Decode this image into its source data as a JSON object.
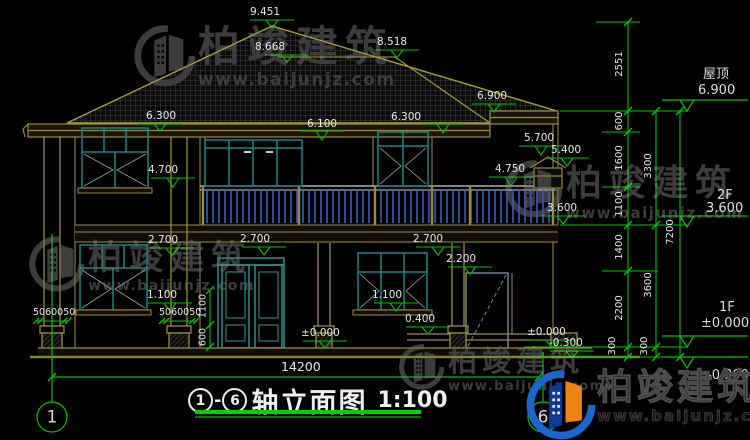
{
  "brand": {
    "name": "柏竣建筑",
    "site": "www.baijunjz.com"
  },
  "title": {
    "axis_from": "1",
    "dash": "-",
    "axis_to": "6",
    "text": "轴立面图",
    "scale": "1:100"
  },
  "axes": {
    "left_bubble": "1",
    "right_bubble": "6"
  },
  "total_width_dim": "14200",
  "right_levels": {
    "roof_label": "屋顶",
    "roof_value": "6.900",
    "f2_label": "2F",
    "f2_value": "3.600",
    "f1_label": "1F",
    "f1_value": "±0.000",
    "ground_value": "-0.300"
  },
  "chains": {
    "a": [
      "2551",
      "600",
      "1600",
      "1100",
      "1400",
      "2200",
      "300"
    ],
    "b": [
      "3300",
      "3600",
      "300"
    ],
    "c": [
      "7200"
    ]
  },
  "marks": {
    "ridge_main": "9.451",
    "ridge_side": "8.518",
    "ridge_rear": "8.668",
    "eave_left": "6.300",
    "win2f_head": "6.100",
    "eave_center": "6.300",
    "eave_right": "6.900",
    "turret_top": "5.700",
    "turret_eave": "5.400",
    "rail_top": "4.750",
    "sill_2f": "4.700",
    "slab_2f": "3.600",
    "head_1f_left": "2.700",
    "head_1f_center": "2.700",
    "head_1f_right": "2.700",
    "door_right_head": "2.200",
    "sill_1f_left": "1.100",
    "sill_1f_right": "1.100",
    "platform": "0.400",
    "floor_main": "±0.000",
    "floor_right": "±0.000",
    "ground_right": "-0.300"
  },
  "small_dims": {
    "col_left": "5060050",
    "col_right": "5060050",
    "v_upper": "1100",
    "v_lower": "600"
  }
}
